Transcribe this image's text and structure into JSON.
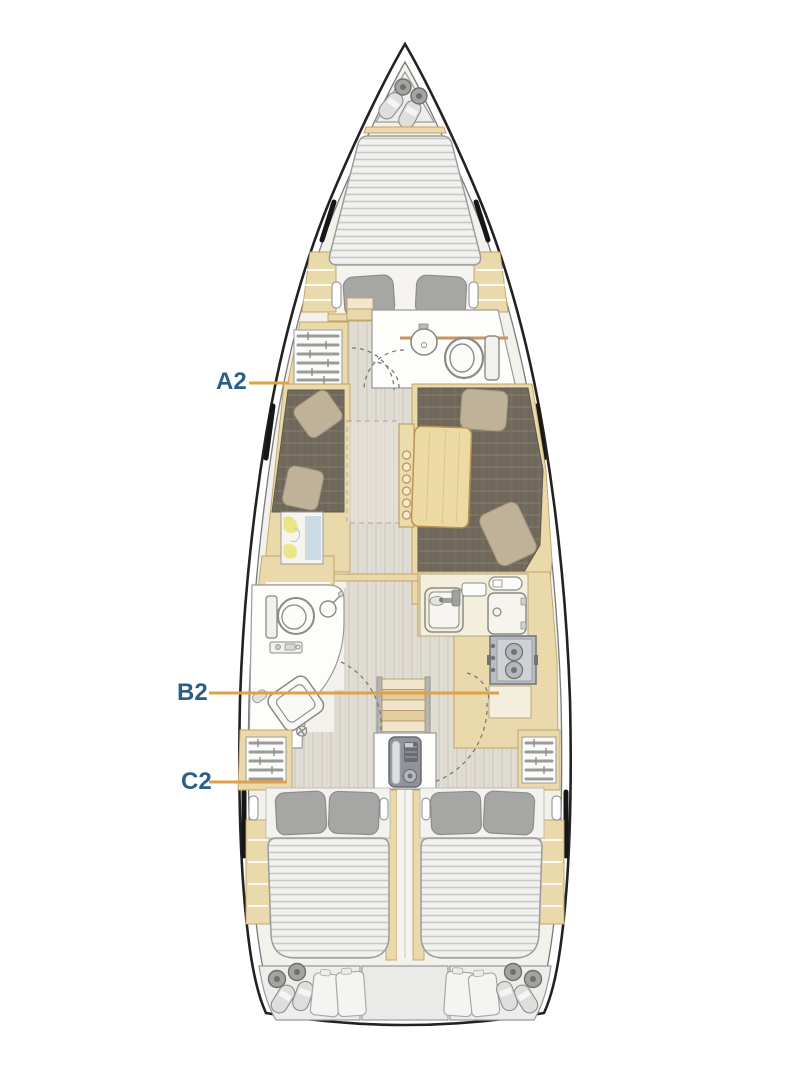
{
  "diagram": {
    "type": "yacht-interior-deck-plan",
    "labels": [
      {
        "id": "A2",
        "text": "A2"
      },
      {
        "id": "B2",
        "text": "B2"
      },
      {
        "id": "C2",
        "text": "C2"
      }
    ],
    "fixtures": [
      "anchor-locker-fenders",
      "v-berth-double-bed",
      "forward-head-sink",
      "forward-head-toilet",
      "wardrobe-shelves",
      "salon-port-settee",
      "salon-starboard-settee",
      "folding-salon-table",
      "chart-table-map",
      "aft-head-toilet",
      "aft-head-basin",
      "galley-sink",
      "galley-fridge",
      "galley-stove",
      "companionway-steps",
      "engine",
      "aft-cabin-port-double-bed",
      "aft-cabin-starboard-double-bed",
      "stern-lockers-fenders-cushions"
    ],
    "colors": {
      "label_text": "#2b5f88",
      "leader_line": "#dfa04a",
      "hull_line": "#222222",
      "hull_inner_line": "#7a7a7a",
      "deck_fill": "#f3f1ec",
      "wood": "#e9d9ab",
      "wood_border": "#c2a267",
      "wood_light": "#f1e7cc",
      "floor": "#e1ddd4",
      "floor_grain": "#d2cdc2",
      "upholstery": "#716a5c",
      "upholstery_seam": "#8d8678",
      "pillow_tan": "#bfb299",
      "pillow_gray": "#a6a6a4",
      "mattress": "#f1f1ef",
      "quilt_line": "#c8c8c4",
      "outline_gray": "#8a8a88",
      "white_room": "#fdfdfc",
      "cream": "#f4eedd",
      "stove": "#b9bdc1",
      "stove_dark": "#70757a",
      "engine": "#90949a",
      "engine_dark": "#686d72",
      "locker": "#ededeb",
      "fender_body": "#dededc",
      "fender_cap": "#a3a3a1",
      "map_paper": "#f6f4ee",
      "map_water": "#a9c5da",
      "map_land": "#e9e26e",
      "counter_line": "#c8955a"
    }
  }
}
